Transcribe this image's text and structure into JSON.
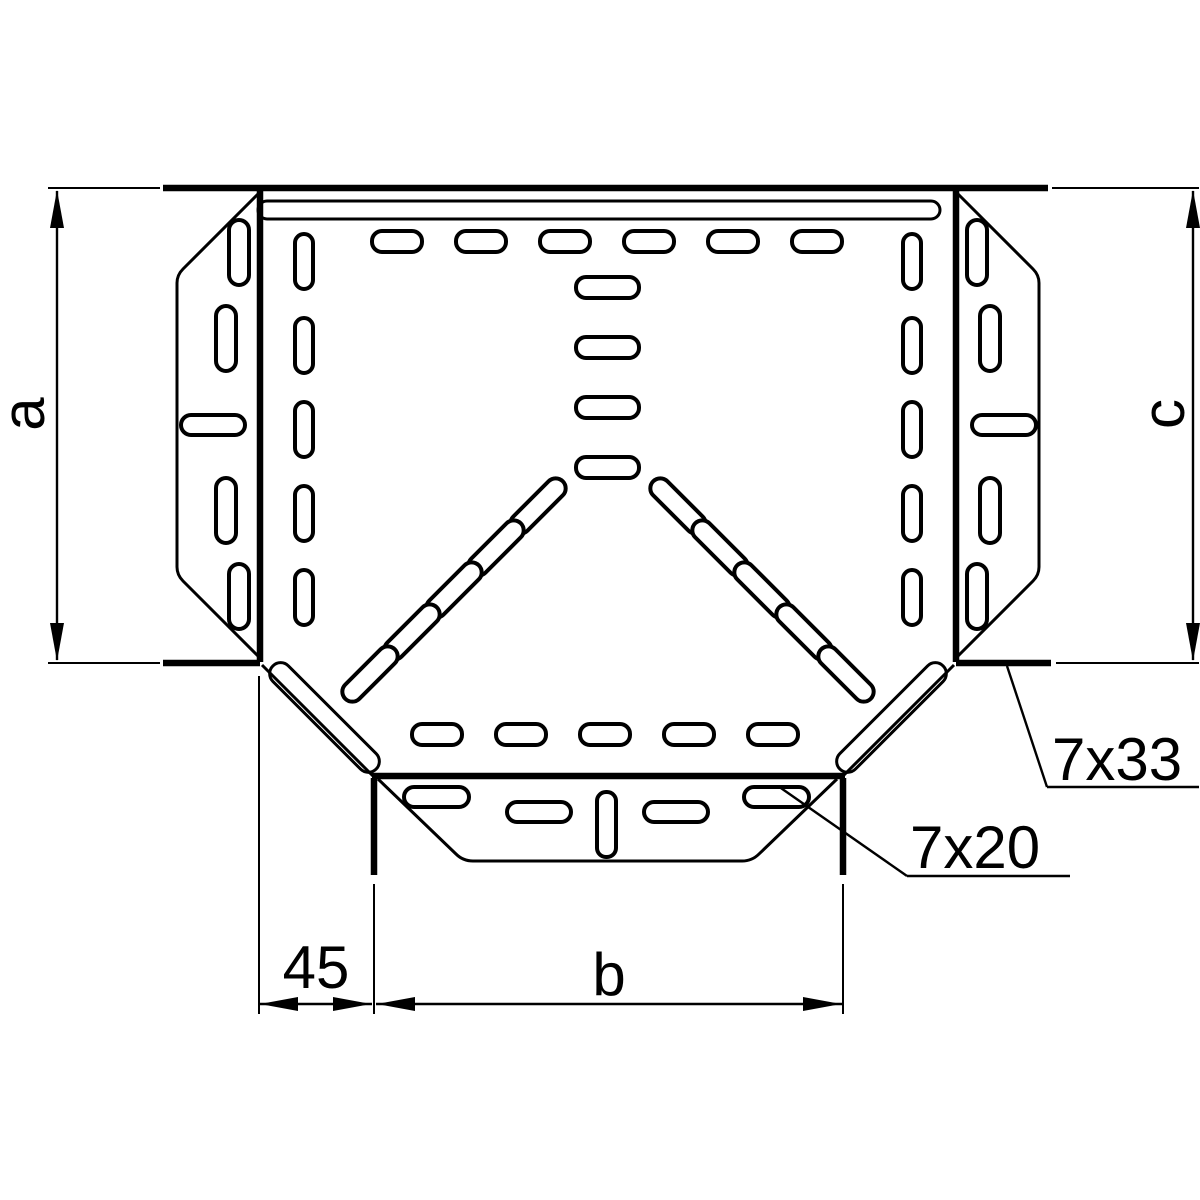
{
  "page": {
    "background": "#ffffff",
    "line_color": "#000000"
  },
  "drawing": {
    "type": "technical-plan-view-cable-tray-tee",
    "labels": {
      "dim_a": "a",
      "dim_c": "c",
      "dim_b": "b",
      "dim_45": "45",
      "slot_7x33": "7x33",
      "slot_7x20": "7x20"
    }
  }
}
